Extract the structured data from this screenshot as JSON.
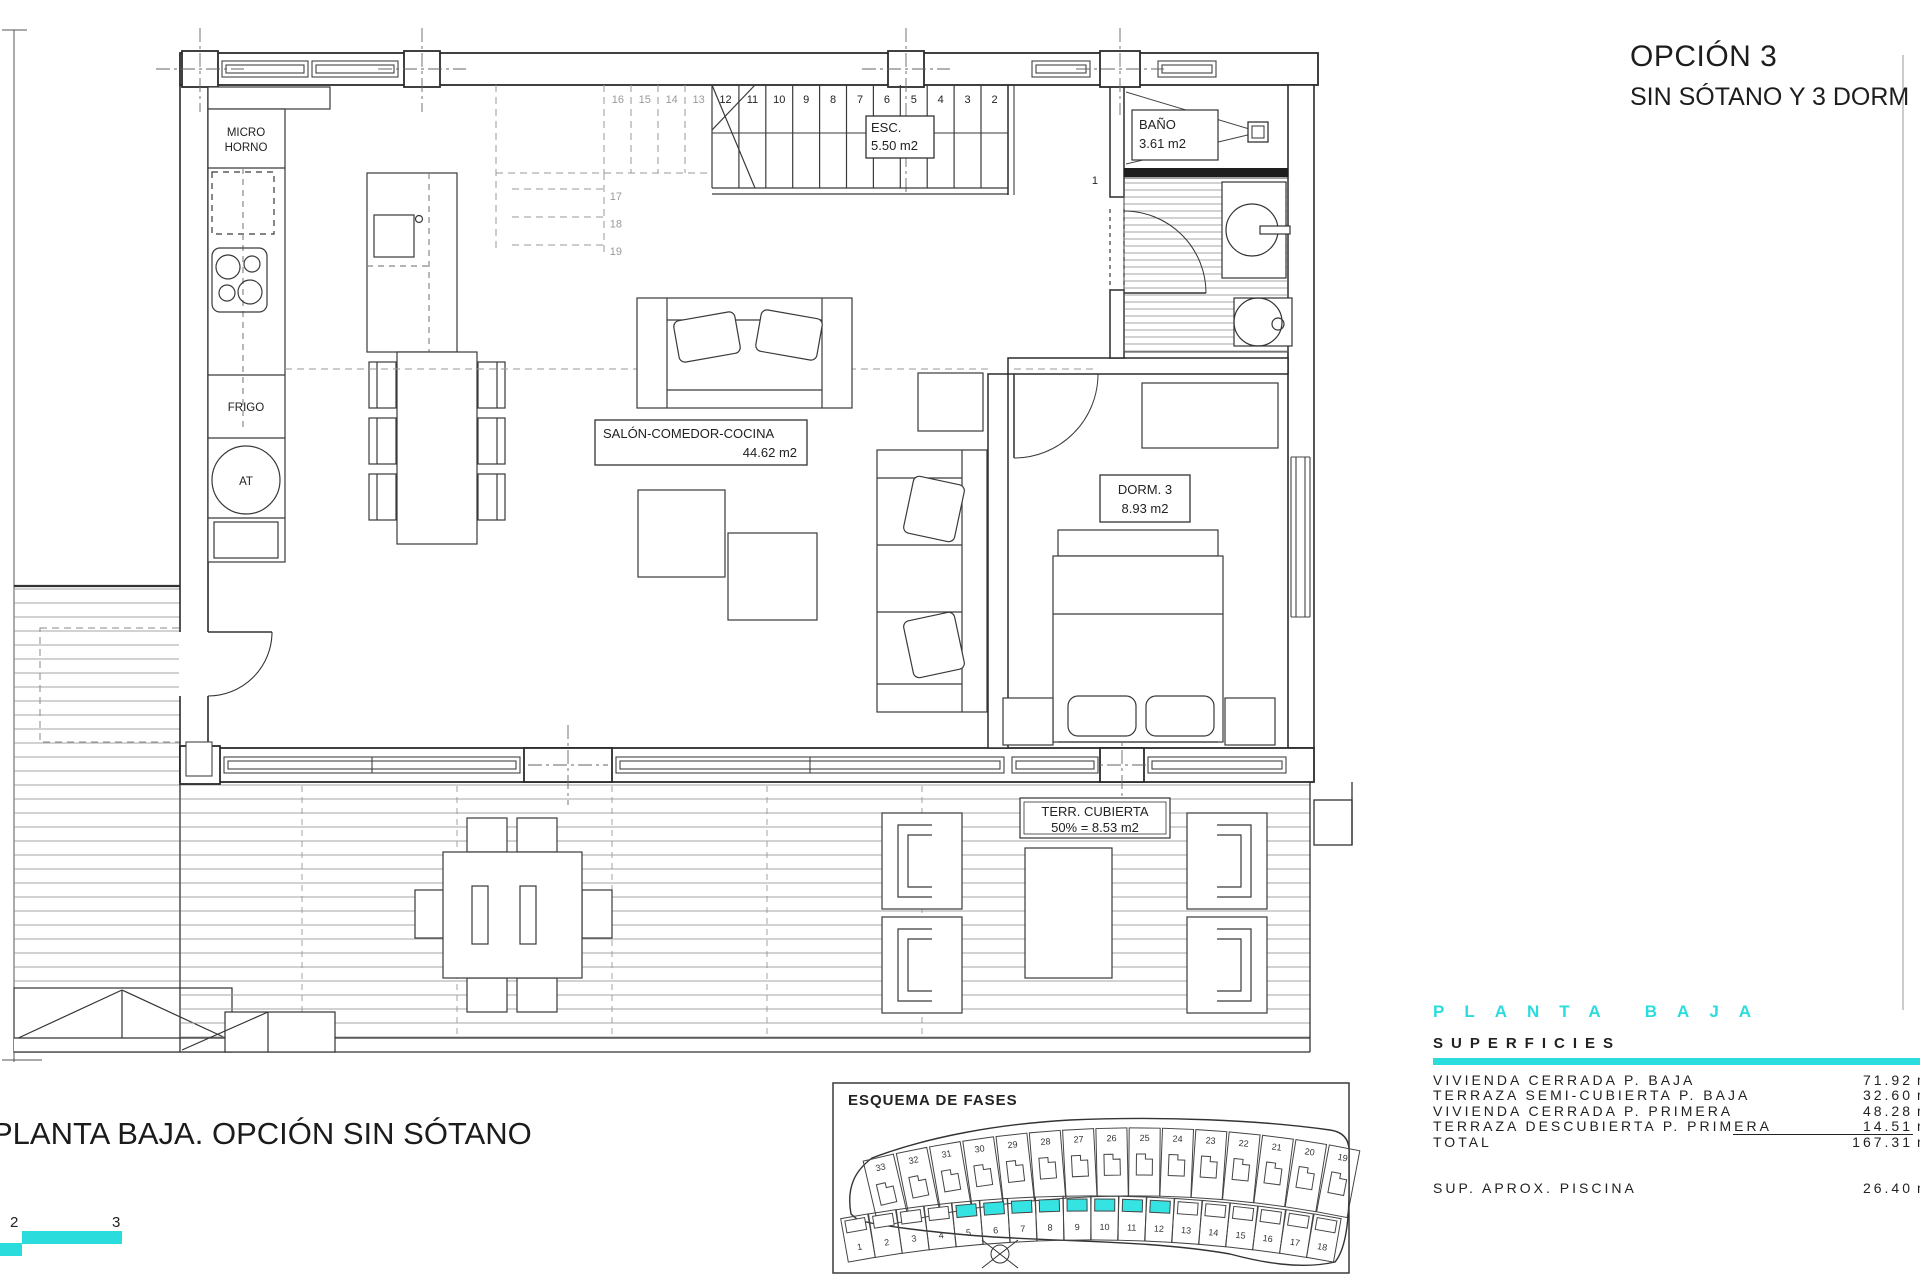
{
  "colors": {
    "accent": "#2bdcdc",
    "highlight": "#35e3e3",
    "ink": "#222222"
  },
  "page": {
    "title_line1": "OPCIÓN 3",
    "title_line2": "SIN SÓTANO Y 3 DORM",
    "caption": "PLANTA BAJA. OPCIÓN SIN SÓTANO"
  },
  "plan": {
    "labels": {
      "micro_1": "MICRO",
      "micro_2": "HORNO",
      "frigo": "FRIGO",
      "at": "AT",
      "esc_1": "ESC.",
      "esc_2": "5.50 m2",
      "bano_1": "BAÑO",
      "bano_2": "3.61 m2",
      "salon_1": "SALÓN-COMEDOR-COCINA",
      "salon_2": "44.62 m2",
      "dorm_1": "DORM. 3",
      "dorm_2": "8.93 m2",
      "terr_1": "TERR. CUBIERTA",
      "terr_2": "50% = 8.53 m2",
      "step_first": "1"
    },
    "stairs": {
      "solid_numbers": [
        2,
        3,
        4,
        5,
        6,
        7,
        8,
        9,
        10,
        11,
        12
      ],
      "dashed_numbers": [
        13,
        14,
        15,
        16
      ],
      "lower_numbers": [
        17,
        18,
        19
      ]
    }
  },
  "scalebar": {
    "labels": [
      "2",
      "3"
    ]
  },
  "esquema": {
    "title": "ESQUEMA DE FASES",
    "top_row": [
      33,
      32,
      31,
      30,
      29,
      28,
      27,
      26,
      25,
      24,
      23,
      22,
      21,
      20,
      19
    ],
    "bottom_row": [
      1,
      2,
      3,
      4,
      5,
      6,
      7,
      8,
      9,
      10,
      11,
      12,
      13,
      14,
      15,
      16,
      17,
      18
    ],
    "highlighted": [
      5,
      6,
      7,
      8,
      9,
      10,
      11,
      12
    ]
  },
  "surfaces": {
    "heading": "PLANTA BAJA",
    "subheading": "SUPERFICIES",
    "rows": [
      {
        "label": "VIVIENDA CERRADA P. BAJA",
        "value": "71.92",
        "unit": "m2"
      },
      {
        "label": "TERRAZA SEMI-CUBIERTA P. BAJA",
        "value": "32.60",
        "unit": "m2"
      },
      {
        "label": "VIVIENDA CERRADA P. PRIMERA",
        "value": "48.28",
        "unit": "m2"
      },
      {
        "label": "TERRAZA DESCUBIERTA P. PRIMERA",
        "value": "14.51",
        "unit": "m2",
        "underline": true
      },
      {
        "label": "TOTAL",
        "value": "167.31",
        "unit": "m2"
      },
      {
        "label": "SUP.  APROX.  PISCINA",
        "value": "26.40",
        "unit": "m2",
        "gap_before": true
      }
    ]
  }
}
